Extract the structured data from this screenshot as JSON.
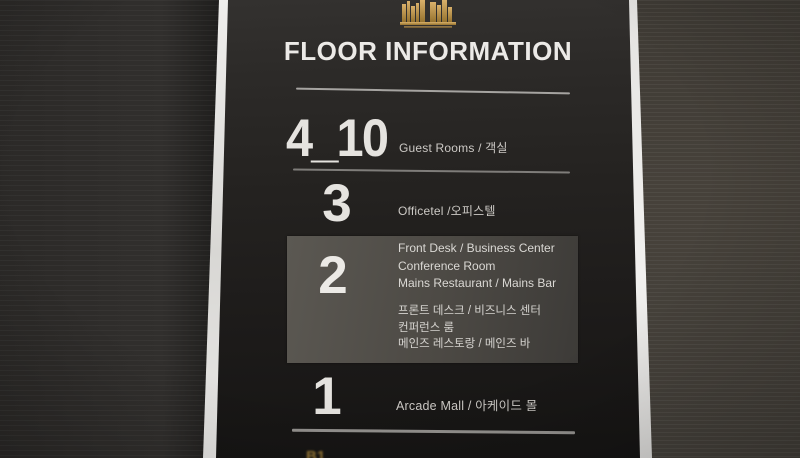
{
  "sign": {
    "title": "FLOOR INFORMATION",
    "logo": "gold-building-skyline",
    "floors": [
      {
        "number": "4_10",
        "label": "Guest Rooms / 객실"
      },
      {
        "number": "3",
        "label": "Officetel /오피스텔"
      },
      {
        "number": "2",
        "highlighted": true,
        "lines_en": [
          "Front Desk / Business Center",
          "Conference Room",
          "Mains Restaurant / Mains Bar"
        ],
        "lines_ko": [
          "프론트 데스크 / 비즈니스 센터",
          "컨퍼런스 룸",
          "메인즈 레스토랑 / 메인즈 바"
        ]
      },
      {
        "number": "1",
        "label": "Arcade Mall / 아케이드 몰"
      },
      {
        "number": "B1",
        "cropped_at_bottom": true
      }
    ],
    "colors": {
      "gold": "#c9a45a",
      "panel": "#23211f",
      "silver_edge": "#e8e7e4",
      "highlight_box": "#4c4944",
      "text": "#dbd9d5"
    }
  }
}
